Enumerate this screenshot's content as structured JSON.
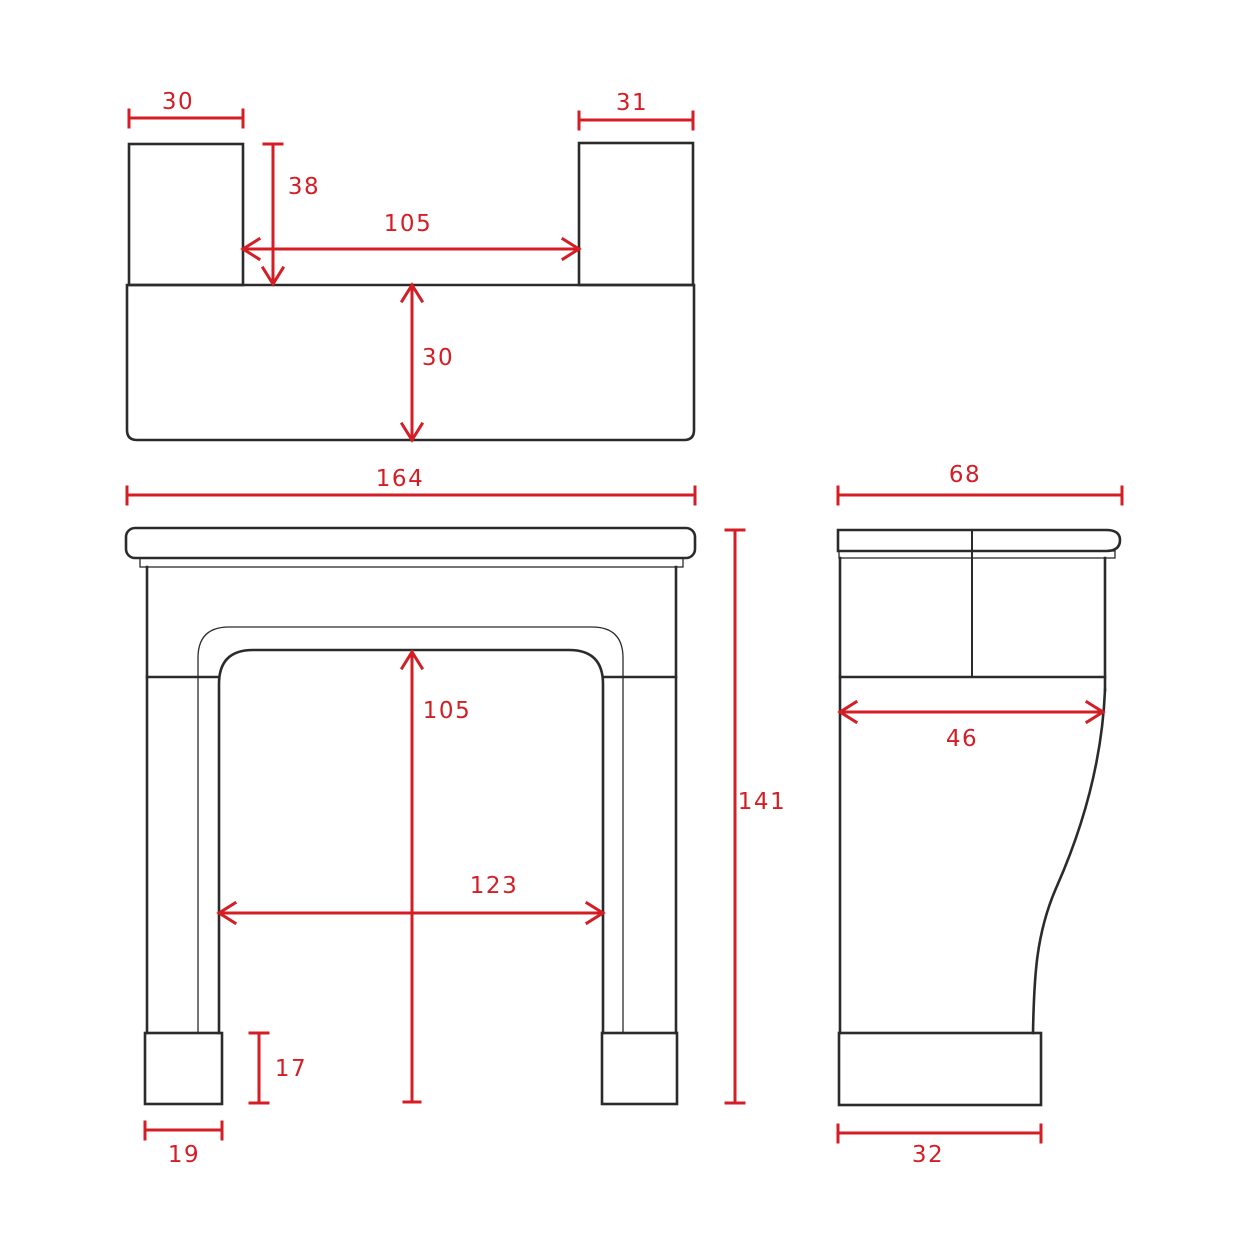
{
  "title": "Fireplace mantel surround - dimensioned technical drawing",
  "colors": {
    "outline": "#2b2b2b",
    "dimension": "#d41e26",
    "background": "#ffffff"
  },
  "views": {
    "plan": {
      "label": "plan view",
      "dims": {
        "left_block_width": "30",
        "right_block_width": "31",
        "block_depth": "38",
        "between_blocks": "105",
        "shelf_depth": "30"
      }
    },
    "front": {
      "label": "front elevation",
      "dims": {
        "overall_width": "164",
        "overall_height": "141",
        "opening_height": "105",
        "opening_width": "123",
        "plinth_height": "17",
        "plinth_width": "19"
      }
    },
    "side": {
      "label": "side elevation",
      "dims": {
        "overall_depth": "68",
        "mid_depth": "46",
        "base_depth": "32"
      }
    }
  }
}
